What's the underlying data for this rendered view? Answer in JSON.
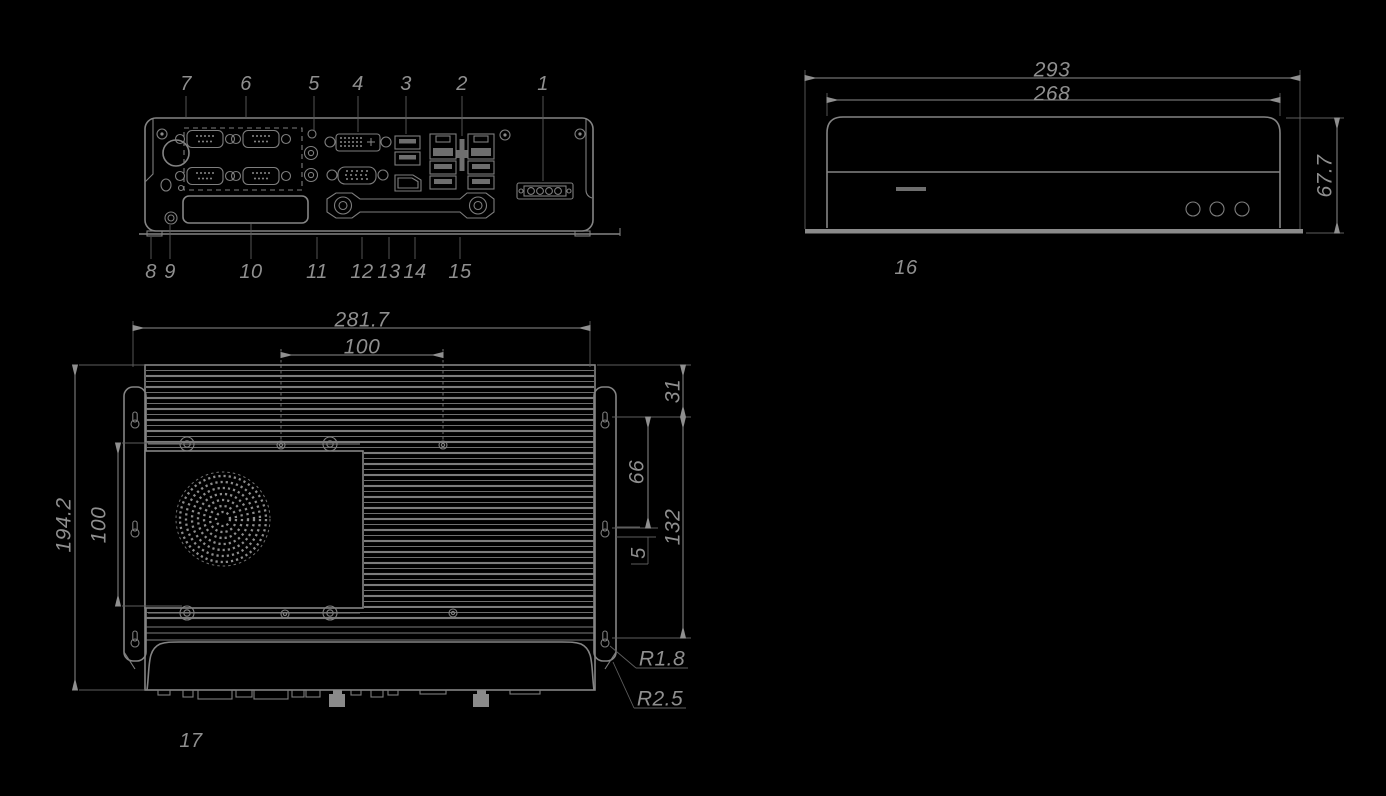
{
  "colors": {
    "background": "#000000",
    "line": "#848484",
    "dim_line": "#8c8c8c",
    "text": "#8f8f8f",
    "fill": "#6e6e6e"
  },
  "front": {
    "callouts_top": [
      "7",
      "6",
      "5",
      "4",
      "3",
      "2",
      "1"
    ],
    "callouts_bottom": [
      "8",
      "9",
      "10",
      "11",
      "12",
      "13",
      "14",
      "15"
    ]
  },
  "side": {
    "callout": "16",
    "dim_overall_width": "293",
    "dim_body_width": "268",
    "dim_height": "67.7"
  },
  "top": {
    "callout": "17",
    "dim_overall_width": "281.7",
    "dim_mount_hole_spacing_x": "100",
    "dim_overall_depth": "194.2",
    "dim_mount_hole_spacing_y": "100",
    "dim_flange_offset": "31",
    "dim_keyhole_gap": "66",
    "dim_keyhole_span": "132",
    "dim_keyhole_slot": "5",
    "dim_radius_keyhole": "R1.8",
    "dim_radius_corner": "R2.5"
  }
}
